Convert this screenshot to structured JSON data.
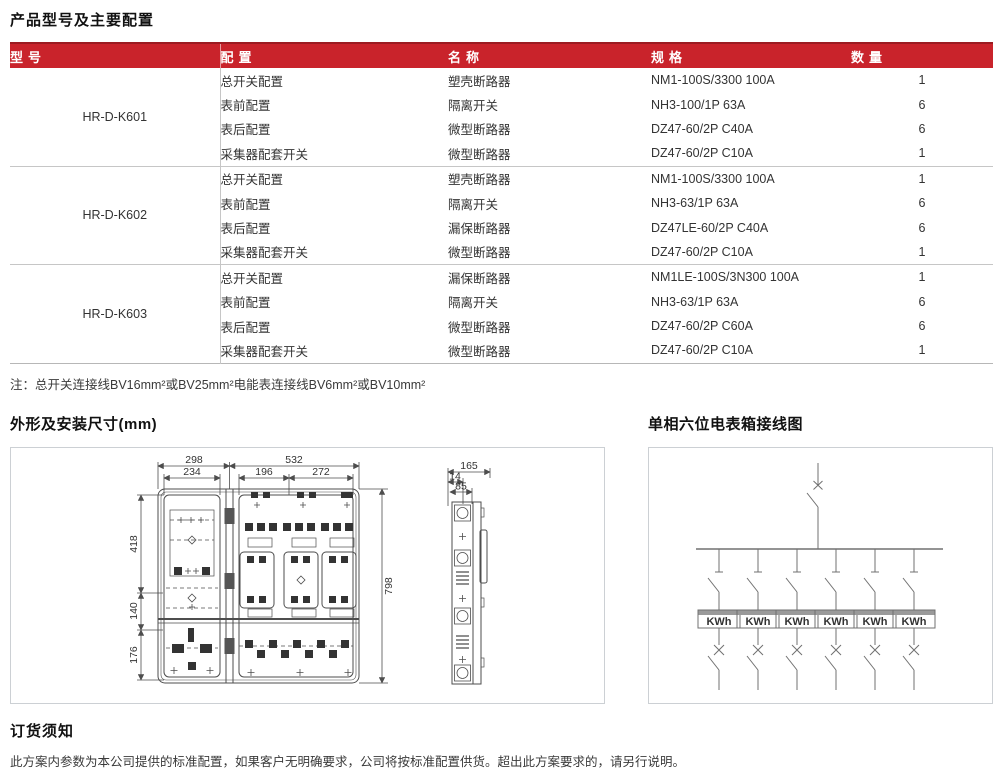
{
  "page": {
    "title": "产品型号及主要配置",
    "note": "注：总开关连接线BV16mm²或BV25mm²电能表连接线BV6mm²或BV10mm²"
  },
  "sections": {
    "outline_title": "外形及安装尺寸(mm)",
    "wiring_title": "单相六位电表箱接线图",
    "order_title": "订货须知",
    "order_text": "此方案内参数为本公司提供的标准配置，如果客户无明确要求，公司将按标准配置供货。超出此方案要求的，请另行说明。"
  },
  "table": {
    "headers": [
      "型号",
      "配置",
      "名称",
      "规格",
      "数量"
    ],
    "groups": [
      {
        "model": "HR-D-K601",
        "rows": [
          [
            "总开关配置",
            "塑壳断路器",
            "NM1-100S/3300 100A",
            "1"
          ],
          [
            "表前配置",
            "隔离开关",
            "NH3-100/1P 63A",
            "6"
          ],
          [
            "表后配置",
            "微型断路器",
            "DZ47-60/2P C40A",
            "6"
          ],
          [
            "采集器配套开关",
            "微型断路器",
            "DZ47-60/2P C10A",
            "1"
          ]
        ]
      },
      {
        "model": "HR-D-K602",
        "rows": [
          [
            "总开关配置",
            "塑壳断路器",
            "NM1-100S/3300 100A",
            "1"
          ],
          [
            "表前配置",
            "隔离开关",
            "NH3-63/1P 63A",
            "6"
          ],
          [
            "表后配置",
            "漏保断路器",
            "DZ47LE-60/2P C40A",
            "6"
          ],
          [
            "采集器配套开关",
            "微型断路器",
            "DZ47-60/2P C10A",
            "1"
          ]
        ]
      },
      {
        "model": "HR-D-K603",
        "rows": [
          [
            "总开关配置",
            "漏保断路器",
            "NM1LE-100S/3N300 100A",
            "1"
          ],
          [
            "表前配置",
            "隔离开关",
            "NH3-63/1P 63A",
            "6"
          ],
          [
            "表后配置",
            "微型断路器",
            "DZ47-60/2P C60A",
            "6"
          ],
          [
            "采集器配套开关",
            "微型断路器",
            "DZ47-60/2P C10A",
            "1"
          ]
        ]
      }
    ]
  },
  "outline": {
    "front_dims": {
      "w1": "298",
      "w2": "532",
      "w3": "234",
      "w4": "196",
      "w5": "272",
      "h1": "418",
      "h2": "140",
      "h3": "176",
      "h_total": "798"
    },
    "side_dims": {
      "d1": "165",
      "d2": "14",
      "d3": "85"
    }
  },
  "wiring": {
    "meters": [
      "KWh",
      "KWh",
      "KWh",
      "KWh",
      "KWh",
      "KWh"
    ]
  },
  "colors": {
    "header_red": "#c9232b",
    "header_red_dark": "#9c1b21",
    "line_gray": "#c6c6c6"
  }
}
